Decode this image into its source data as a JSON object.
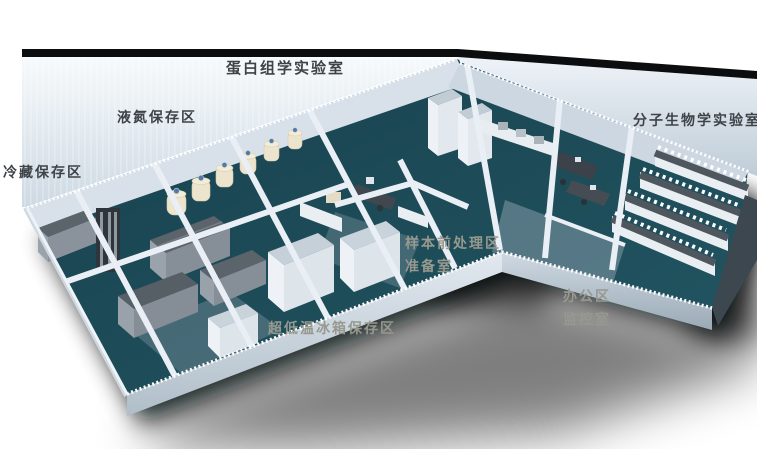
{
  "floorplan": {
    "description": "3D isometric laboratory floor plan render",
    "labels": [
      {
        "id": "proteomics-lab",
        "text": "蛋白组学实验室",
        "style": "wall"
      },
      {
        "id": "liquid-nitrogen-area",
        "text": "液氮保存区",
        "style": "wall"
      },
      {
        "id": "cold-storage-area",
        "text": "冷藏保存区",
        "style": "wall"
      },
      {
        "id": "molecular-biology-lab",
        "text": "分子生物学实验室",
        "style": "wall"
      },
      {
        "id": "sample-pretreatment",
        "text": "样本前处理区",
        "style": "shadow"
      },
      {
        "id": "prep-room",
        "text": "准备室",
        "style": "shadow"
      },
      {
        "id": "office-area",
        "text": "办公区",
        "style": "shadow"
      },
      {
        "id": "monitor-room",
        "text": "监控室",
        "style": "shadow"
      },
      {
        "id": "ult-freezer-area",
        "text": "超低温冰箱保存区",
        "style": "shadow"
      }
    ],
    "colors": {
      "floor_teal": "#1d4b58",
      "wall_light": "#e9eff5",
      "roof_edge_black": "#0c0d0f",
      "wall_label_text": "#3f4347",
      "shadow_label_text": "#97998f",
      "dewar_cream": "#ece4cd",
      "dewar_cap_blue": "#4a7cb3",
      "freezer_gray": "#5b636b"
    }
  }
}
